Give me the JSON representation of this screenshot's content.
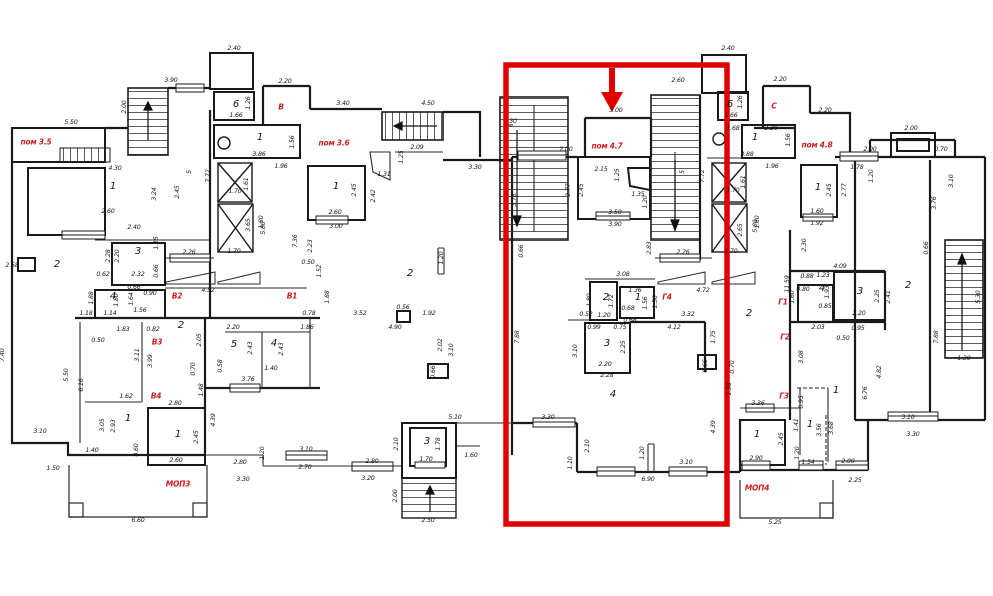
{
  "document": {
    "kind": "architectural floor plan (building storey with apartment sections)",
    "highlight_color": "#e10000",
    "label_color": "#cf1f1f",
    "wall_color": "#1a1a1a"
  },
  "highlight": {
    "rect": {
      "x": 506,
      "y": 65,
      "w": 221,
      "h": 459
    },
    "arrow": {
      "x": 612,
      "y_top": 68,
      "y_tip": 110
    }
  },
  "section_labels": [
    [
      36,
      142,
      "пом 3.5"
    ],
    [
      281,
      107,
      "В"
    ],
    [
      334,
      143,
      "пом 3.6"
    ],
    [
      177,
      296,
      "В2"
    ],
    [
      292,
      296,
      "В1"
    ],
    [
      157,
      342,
      "В3"
    ],
    [
      156,
      396,
      "В4"
    ],
    [
      178,
      484,
      "МОП3"
    ],
    [
      607,
      146,
      "пом 4.7"
    ],
    [
      667,
      297,
      "Г4"
    ],
    [
      774,
      106,
      "С"
    ],
    [
      817,
      145,
      "пом 4.8"
    ],
    [
      783,
      302,
      "Г1"
    ],
    [
      785,
      337,
      "Г2"
    ],
    [
      784,
      396,
      "Г3"
    ],
    [
      757,
      488,
      "МОП4"
    ]
  ],
  "room_numbers": [
    [
      113,
      187,
      "1"
    ],
    [
      57,
      265,
      "2"
    ],
    [
      138,
      252,
      "3"
    ],
    [
      113,
      297,
      "4"
    ],
    [
      181,
      326,
      "2"
    ],
    [
      128,
      419,
      "1"
    ],
    [
      178,
      435,
      "1"
    ],
    [
      234,
      345,
      "5"
    ],
    [
      274,
      344,
      "4"
    ],
    [
      336,
      187,
      "1"
    ],
    [
      260,
      138,
      "1"
    ],
    [
      236,
      105,
      "6"
    ],
    [
      410,
      274,
      "2"
    ],
    [
      427,
      442,
      "3"
    ],
    [
      606,
      298,
      "2"
    ],
    [
      638,
      298,
      "1"
    ],
    [
      607,
      344,
      "3"
    ],
    [
      613,
      395,
      "4"
    ],
    [
      730,
      105,
      "6"
    ],
    [
      755,
      138,
      "1"
    ],
    [
      818,
      188,
      "1"
    ],
    [
      822,
      289,
      "4"
    ],
    [
      860,
      292,
      "3"
    ],
    [
      908,
      286,
      "2"
    ],
    [
      749,
      314,
      "2"
    ],
    [
      836,
      391,
      "1"
    ],
    [
      757,
      435,
      "1"
    ],
    [
      810,
      425,
      "1"
    ]
  ],
  "dimensions": [
    [
      234,
      49,
      "2.40"
    ],
    [
      171,
      81,
      "3.90"
    ],
    [
      71,
      123,
      "5.50"
    ],
    [
      125,
      107,
      "2.00",
      1
    ],
    [
      115,
      169,
      "4.30"
    ],
    [
      249,
      103,
      "1.26",
      1
    ],
    [
      236,
      116,
      "1.66"
    ],
    [
      259,
      155,
      "3.86"
    ],
    [
      293,
      142,
      "1.56",
      1
    ],
    [
      285,
      82,
      "2.20"
    ],
    [
      343,
      104,
      "3.40"
    ],
    [
      428,
      104,
      "4.50"
    ],
    [
      417,
      148,
      "2.09"
    ],
    [
      402,
      157,
      "1.25",
      1
    ],
    [
      384,
      175,
      "1.31"
    ],
    [
      475,
      168,
      "3.30"
    ],
    [
      281,
      167,
      "1.96"
    ],
    [
      209,
      176,
      "7.72",
      1
    ],
    [
      235,
      192,
      "1.70"
    ],
    [
      247,
      184,
      "1.61",
      1
    ],
    [
      355,
      190,
      "2.45",
      1
    ],
    [
      374,
      196,
      "2.42",
      1
    ],
    [
      335,
      213,
      "2.60"
    ],
    [
      336,
      227,
      "3.00"
    ],
    [
      262,
      222,
      "1.80",
      1
    ],
    [
      190,
      172,
      "5",
      1
    ],
    [
      155,
      194,
      "3.24",
      1
    ],
    [
      178,
      192,
      "2.45",
      1
    ],
    [
      108,
      212,
      "2.60"
    ],
    [
      12,
      266,
      "2.58"
    ],
    [
      134,
      228,
      "2.40"
    ],
    [
      157,
      243,
      "1.15",
      1
    ],
    [
      109,
      256,
      "2.28",
      1
    ],
    [
      118,
      256,
      "2.20",
      1
    ],
    [
      103,
      275,
      "0.62"
    ],
    [
      138,
      275,
      "2.32"
    ],
    [
      157,
      271,
      "0.66",
      1
    ],
    [
      189,
      253,
      "2.26"
    ],
    [
      234,
      252,
      "1.70"
    ],
    [
      249,
      225,
      "3.65",
      1
    ],
    [
      208,
      291,
      "4.52"
    ],
    [
      92,
      298,
      "1.88",
      1
    ],
    [
      117,
      300,
      "1.80",
      1
    ],
    [
      86,
      314,
      "1.18"
    ],
    [
      110,
      314,
      "1.14"
    ],
    [
      140,
      311,
      "1.56"
    ],
    [
      132,
      299,
      "1.64",
      1
    ],
    [
      134,
      288,
      "0.66"
    ],
    [
      150,
      294,
      "0.90"
    ],
    [
      296,
      241,
      "7.36",
      1
    ],
    [
      311,
      246,
      "2.23",
      1
    ],
    [
      308,
      263,
      "0.50"
    ],
    [
      320,
      271,
      "1.52",
      1
    ],
    [
      328,
      297,
      "1.88",
      1
    ],
    [
      309,
      314,
      "0.78"
    ],
    [
      307,
      328,
      "1.86"
    ],
    [
      360,
      314,
      "3.52"
    ],
    [
      403,
      308,
      "0.56"
    ],
    [
      429,
      314,
      "1.92"
    ],
    [
      395,
      328,
      "4.90"
    ],
    [
      441,
      345,
      "2.02",
      1
    ],
    [
      452,
      350,
      "3.10",
      1
    ],
    [
      434,
      372,
      "0.66",
      1
    ],
    [
      442,
      258,
      "1.20",
      1
    ],
    [
      264,
      228,
      "5.80",
      1
    ],
    [
      123,
      330,
      "1.83"
    ],
    [
      153,
      330,
      "0.82"
    ],
    [
      200,
      340,
      "2.05",
      1
    ],
    [
      233,
      328,
      "2.20"
    ],
    [
      251,
      348,
      "2.43",
      1
    ],
    [
      282,
      349,
      "2.43",
      1
    ],
    [
      194,
      369,
      "0.70",
      1
    ],
    [
      221,
      366,
      "0.58",
      1
    ],
    [
      248,
      380,
      "3.76"
    ],
    [
      271,
      369,
      "1.40"
    ],
    [
      202,
      390,
      "1.48",
      1
    ],
    [
      126,
      397,
      "1.62"
    ],
    [
      175,
      404,
      "2.80"
    ],
    [
      214,
      420,
      "4.39",
      1
    ],
    [
      138,
      355,
      "3.11",
      1
    ],
    [
      151,
      361,
      "3.99",
      1
    ],
    [
      3,
      355,
      "7.40",
      1
    ],
    [
      67,
      375,
      "5.50",
      1
    ],
    [
      82,
      385,
      "6.16",
      1
    ],
    [
      98,
      341,
      "0.50"
    ],
    [
      103,
      425,
      "3.05",
      1
    ],
    [
      114,
      426,
      "2.93",
      1
    ],
    [
      137,
      450,
      "0.60",
      1
    ],
    [
      92,
      451,
      "1.40"
    ],
    [
      40,
      432,
      "3.10"
    ],
    [
      53,
      469,
      "1.50"
    ],
    [
      197,
      437,
      "2.45",
      1
    ],
    [
      176,
      461,
      "2.60"
    ],
    [
      240,
      463,
      "2.80"
    ],
    [
      243,
      480,
      "3.30"
    ],
    [
      138,
      521,
      "6.60"
    ],
    [
      263,
      453,
      "1.20",
      1
    ],
    [
      306,
      450,
      "3.10"
    ],
    [
      305,
      468,
      "2.70"
    ],
    [
      372,
      462,
      "2.80"
    ],
    [
      368,
      479,
      "3.20"
    ],
    [
      397,
      444,
      "2.10",
      1
    ],
    [
      439,
      444,
      "1.78",
      1
    ],
    [
      426,
      460,
      "1.70"
    ],
    [
      455,
      418,
      "5.10"
    ],
    [
      471,
      456,
      "1.60"
    ],
    [
      396,
      496,
      "2.00",
      1
    ],
    [
      428,
      521,
      "2.50"
    ],
    [
      728,
      49,
      "2.40"
    ],
    [
      678,
      81,
      "2.60"
    ],
    [
      616,
      111,
      "3.00"
    ],
    [
      513,
      122,
      "30"
    ],
    [
      566,
      150,
      "2.00"
    ],
    [
      601,
      170,
      "2.15"
    ],
    [
      618,
      175,
      "1.25",
      1
    ],
    [
      569,
      190,
      "2.77",
      1
    ],
    [
      582,
      190,
      "2.45",
      1
    ],
    [
      638,
      195,
      "1.35"
    ],
    [
      646,
      202,
      "1.20",
      1
    ],
    [
      615,
      213,
      "3.50"
    ],
    [
      615,
      225,
      "3.90"
    ],
    [
      515,
      200,
      "3.76",
      1
    ],
    [
      683,
      172,
      "5",
      1
    ],
    [
      703,
      176,
      "7.72",
      1
    ],
    [
      747,
      155,
      "3.88"
    ],
    [
      733,
      191,
      "1.70"
    ],
    [
      744,
      182,
      "1.61",
      1
    ],
    [
      741,
      230,
      "2.65",
      1
    ],
    [
      756,
      226,
      "5.80",
      1
    ],
    [
      731,
      252,
      "1.70"
    ],
    [
      650,
      248,
      "2.83",
      1
    ],
    [
      683,
      253,
      "2.26"
    ],
    [
      623,
      275,
      "3.08"
    ],
    [
      635,
      291,
      "1.36"
    ],
    [
      612,
      301,
      "1.72",
      1
    ],
    [
      590,
      300,
      "1.80",
      1
    ],
    [
      646,
      303,
      "1.56",
      1
    ],
    [
      656,
      302,
      "1.56",
      1
    ],
    [
      703,
      291,
      "4.72"
    ],
    [
      586,
      315,
      "0.52"
    ],
    [
      604,
      316,
      "1.20"
    ],
    [
      628,
      309,
      "0.68"
    ],
    [
      630,
      321,
      "0.68"
    ],
    [
      688,
      315,
      "3.32"
    ],
    [
      594,
      328,
      "0.99"
    ],
    [
      620,
      328,
      "0.75"
    ],
    [
      674,
      328,
      "4.12"
    ],
    [
      624,
      347,
      "2.25",
      1
    ],
    [
      576,
      351,
      "3.10",
      1
    ],
    [
      714,
      337,
      "1.75",
      1
    ],
    [
      605,
      365,
      "2.20"
    ],
    [
      607,
      376,
      "2.28"
    ],
    [
      706,
      366,
      "0.66",
      1
    ],
    [
      733,
      367,
      "0.70",
      1
    ],
    [
      730,
      389,
      "1.58",
      1
    ],
    [
      522,
      251,
      "0.66",
      1
    ],
    [
      518,
      337,
      "7.88",
      1
    ],
    [
      548,
      418,
      "3.30"
    ],
    [
      714,
      427,
      "4.39",
      1
    ],
    [
      588,
      446,
      "2.10",
      1
    ],
    [
      571,
      463,
      "1.10",
      1
    ],
    [
      643,
      453,
      "1.20",
      1
    ],
    [
      686,
      463,
      "3.10"
    ],
    [
      648,
      480,
      "6.90"
    ],
    [
      780,
      80,
      "2.20"
    ],
    [
      825,
      111,
      "2.20"
    ],
    [
      771,
      129,
      "2.20"
    ],
    [
      789,
      140,
      "1.56",
      1
    ],
    [
      741,
      102,
      "1.26",
      1
    ],
    [
      731,
      116,
      "1.66"
    ],
    [
      733,
      129,
      "1.68"
    ],
    [
      911,
      129,
      "2.00"
    ],
    [
      870,
      150,
      "2.00"
    ],
    [
      941,
      150,
      "0.70"
    ],
    [
      857,
      168,
      "1.78"
    ],
    [
      872,
      176,
      "1.20",
      1
    ],
    [
      830,
      190,
      "2.45",
      1
    ],
    [
      845,
      190,
      "2.77",
      1
    ],
    [
      935,
      203,
      "3.76",
      1
    ],
    [
      952,
      181,
      "3.10",
      1
    ],
    [
      817,
      212,
      "1.60"
    ],
    [
      817,
      224,
      "1.92"
    ],
    [
      772,
      167,
      "1.96"
    ],
    [
      758,
      222,
      "1.80",
      1
    ],
    [
      805,
      245,
      "2.30",
      1
    ],
    [
      807,
      277,
      "0.88"
    ],
    [
      823,
      276,
      "1.23"
    ],
    [
      840,
      267,
      "4.09"
    ],
    [
      788,
      284,
      "11.59",
      1
    ],
    [
      803,
      290,
      "0.80"
    ],
    [
      828,
      292,
      "1.93",
      1
    ],
    [
      878,
      296,
      "2.25",
      1
    ],
    [
      889,
      297,
      "2.41",
      1
    ],
    [
      927,
      248,
      "0.66",
      1
    ],
    [
      793,
      297,
      "1.60",
      1
    ],
    [
      825,
      307,
      "0.85"
    ],
    [
      859,
      314,
      "2.20"
    ],
    [
      818,
      328,
      "2.03"
    ],
    [
      858,
      329,
      "0.95"
    ],
    [
      843,
      339,
      "0.50"
    ],
    [
      802,
      357,
      "3.08",
      1
    ],
    [
      937,
      337,
      "7.88",
      1
    ],
    [
      979,
      297,
      "5.30",
      1
    ],
    [
      964,
      359,
      "1.30"
    ],
    [
      880,
      372,
      "4.82",
      1
    ],
    [
      866,
      393,
      "6.76",
      1
    ],
    [
      802,
      402,
      "0.95",
      1
    ],
    [
      758,
      404,
      "3.36"
    ],
    [
      908,
      418,
      "3.10"
    ],
    [
      782,
      439,
      "2.45",
      1
    ],
    [
      797,
      425,
      "1.41",
      1
    ],
    [
      820,
      430,
      "3.56",
      1
    ],
    [
      832,
      428,
      "3.68",
      1
    ],
    [
      798,
      453,
      "1.20",
      1
    ],
    [
      808,
      463,
      "1.54"
    ],
    [
      848,
      462,
      "2.00"
    ],
    [
      756,
      459,
      "2.90"
    ],
    [
      855,
      481,
      "2.25"
    ],
    [
      775,
      523,
      "5.25"
    ],
    [
      913,
      435,
      "3.30"
    ]
  ]
}
